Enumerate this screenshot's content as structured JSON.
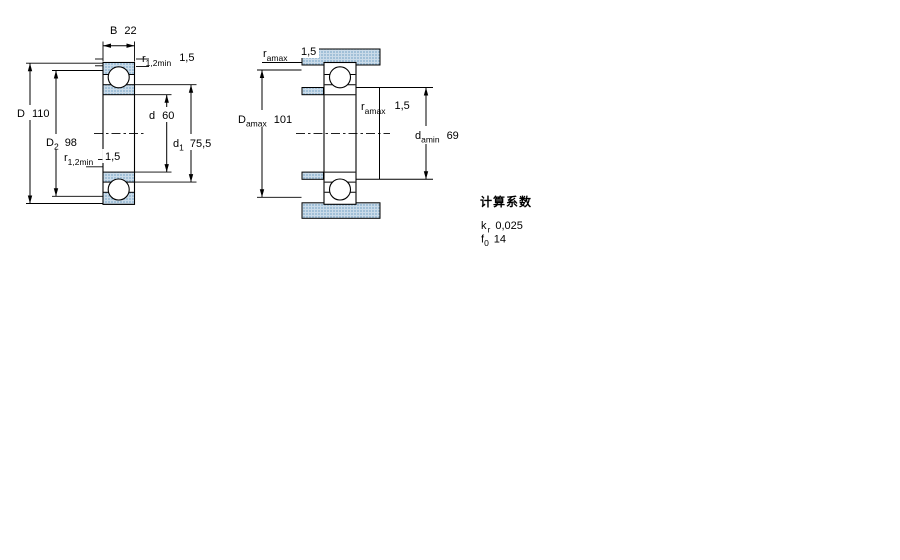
{
  "figure_type": "bearing-dimension-drawing",
  "left_drawing": {
    "B": {
      "label": "B",
      "sub": "",
      "value": "22"
    },
    "r_top": {
      "label": "r",
      "sub": "1,2min",
      "value": "1,5"
    },
    "D": {
      "label": "D",
      "sub": "",
      "value": "110"
    },
    "d": {
      "label": "d",
      "sub": "",
      "value": "60"
    },
    "D2": {
      "label": "D",
      "sub": "2",
      "value": "98"
    },
    "d1": {
      "label": "d",
      "sub": "1",
      "value": "75,5"
    },
    "r_bot": {
      "label": "r",
      "sub": "1,2min",
      "value": "1,5"
    }
  },
  "right_drawing": {
    "r_top": {
      "label": "r",
      "sub": "amax",
      "value": "1,5"
    },
    "Damax": {
      "label": "D",
      "sub": "amax",
      "value": "101"
    },
    "r_mid": {
      "label": "r",
      "sub": "amax",
      "value": "1,5"
    },
    "damin": {
      "label": "d",
      "sub": "amin",
      "value": "69"
    }
  },
  "calculation_factors": {
    "title": "计算系数",
    "kr": {
      "label": "k",
      "sub": "r",
      "value": "0,025"
    },
    "f0": {
      "label": "f",
      "sub": "0",
      "value": "14"
    }
  },
  "colors": {
    "line": "#000000",
    "hatch_base": "#cadbe9",
    "hatch_dot": "#7fa9c9",
    "background": "#ffffff"
  }
}
